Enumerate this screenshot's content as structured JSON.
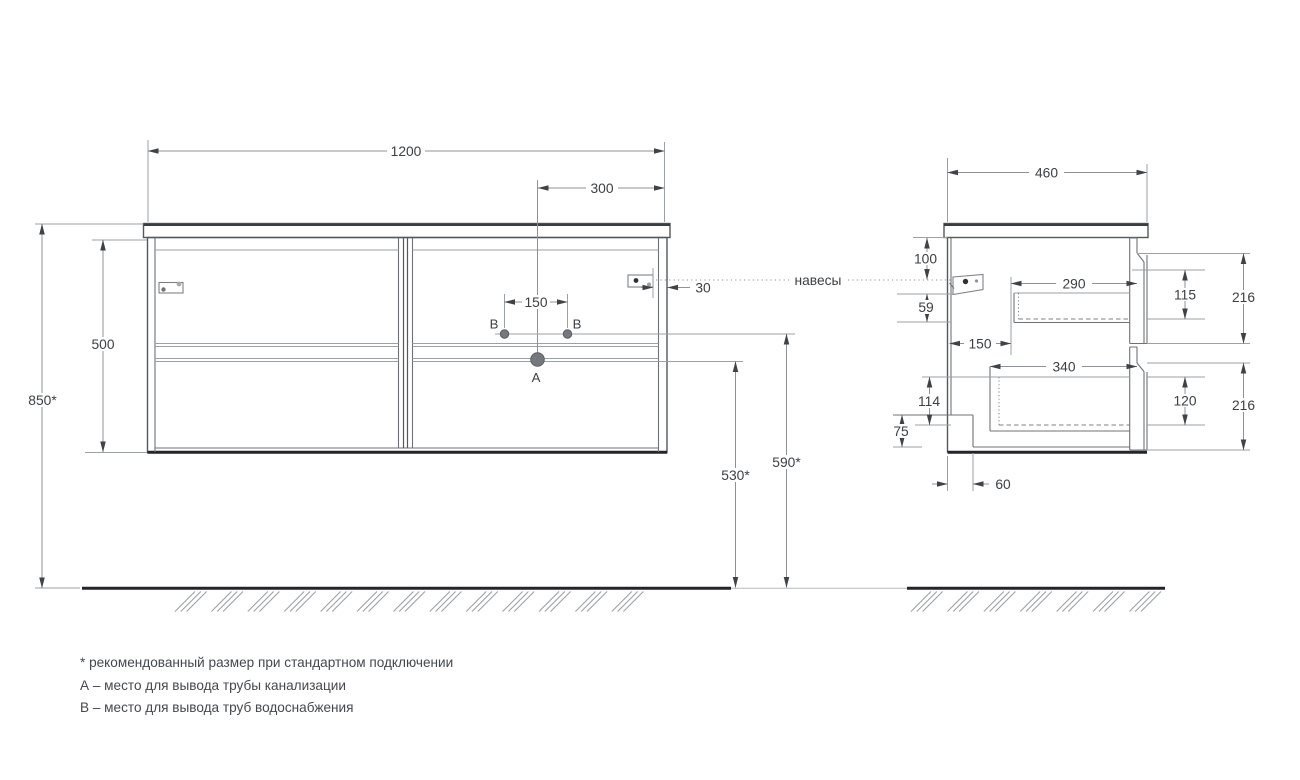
{
  "front_view": {
    "width": "1200",
    "sink_offset": "300",
    "water_spacing": "150",
    "body_height": "500",
    "install_height": "850*",
    "hanger_inset": "30",
    "drain_height": "530*",
    "water_height": "590*",
    "drain_point": "A",
    "water_point_left": "B",
    "water_point_right": "B"
  },
  "side_view": {
    "depth": "460",
    "hanger_top_offset": "100",
    "hanger_bottom_gap": "59",
    "drawer1_depth": "290",
    "drawer1_height": "115",
    "drawer1_front": "216",
    "back_offset": "150",
    "drawer2_depth": "340",
    "drawer2_height": "120",
    "drawer2_front": "216",
    "bottom_back_height": "114",
    "recess_height": "75",
    "recess_depth": "60"
  },
  "callouts": {
    "hangers_label": "навесы"
  },
  "footnotes": {
    "asterisk": "* рекомендованный размер при стандартном подключении",
    "point_a": "А – место для вывода трубы канализации",
    "point_b": "В – место для вывода труб водоснабжения"
  },
  "colors": {
    "line": "#6e7276",
    "dark": "#23252a",
    "dim_text": "#3c4043",
    "background": "#ffffff"
  }
}
